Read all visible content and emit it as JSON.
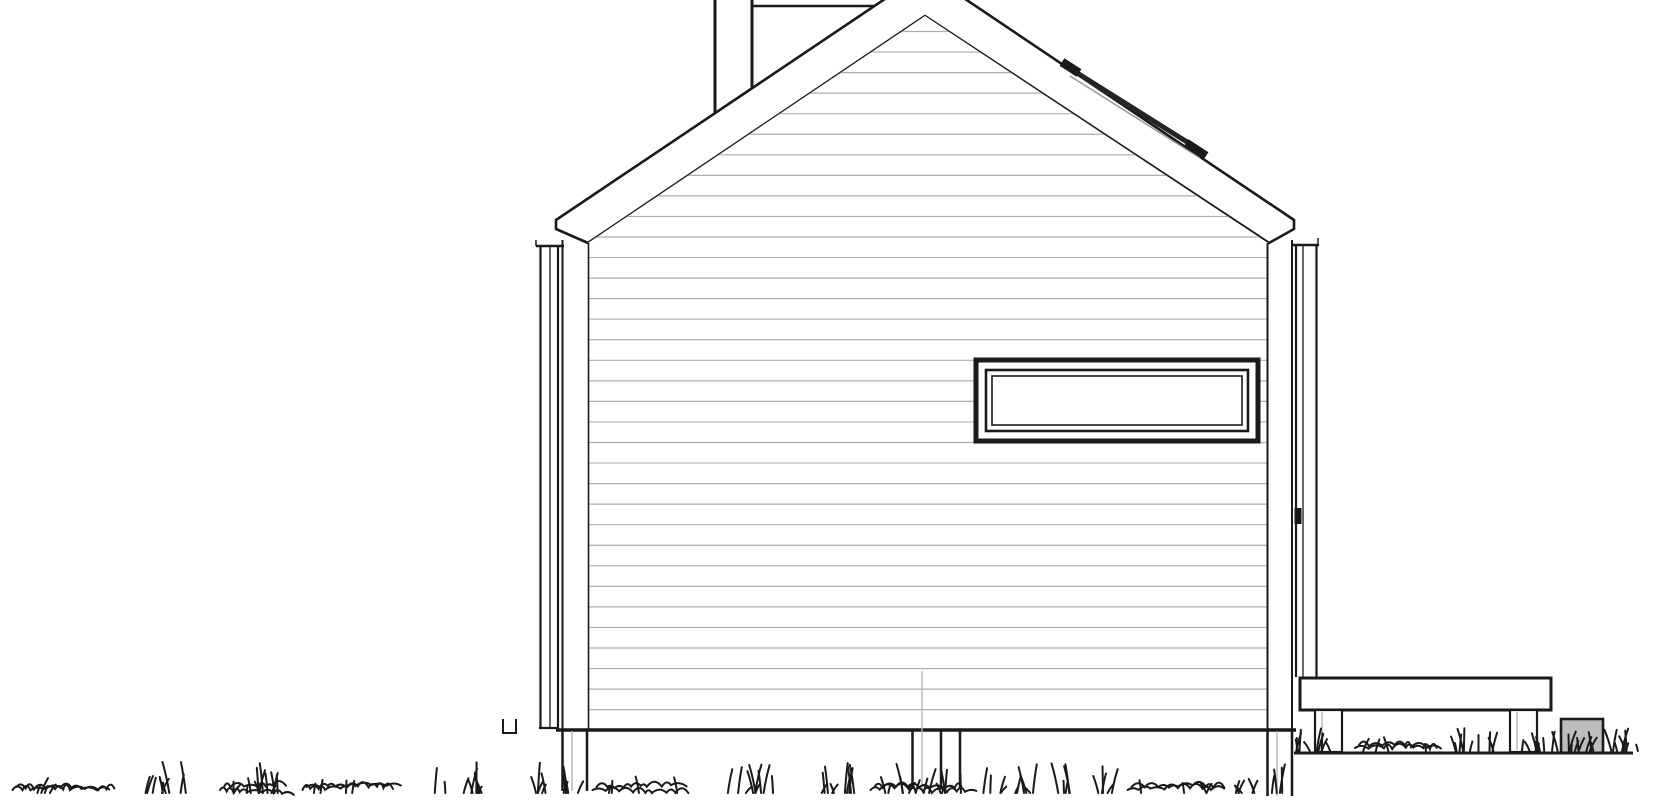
{
  "meta": {
    "description": "Architectural gable-end elevation drawing of a small house: gable roof with fascia band, chimney cut by image top, roof rail on right slope, horizontal lap siding, ribbon window, corner downspouts, pier foundation in grass, right-side deck on posts with stone block"
  },
  "canvas": {
    "w": 1670,
    "h": 800
  },
  "colors": {
    "background": "#ffffff",
    "line": "#1a1a1a",
    "siding_line": "#aeaeae",
    "soft_gray": "#b6b6b6",
    "stone_fill": "#bdbdbd",
    "rail_gray": "#9a9a9a"
  },
  "wall_clip": [
    [
      588,
      243
    ],
    [
      925,
      16
    ],
    [
      1268,
      243
    ],
    [
      1268,
      729
    ],
    [
      588,
      729
    ]
  ],
  "background_shapes": [
    {
      "n": "chimney-left-edge",
      "k": "line",
      "x1": 715,
      "y1": 0,
      "x2": 715,
      "y2": 118,
      "w": 3
    },
    {
      "n": "chimney-right-edge",
      "k": "line",
      "x1": 752,
      "y1": 0,
      "x2": 752,
      "y2": 92,
      "w": 3
    },
    {
      "n": "chimney-ledge",
      "k": "line",
      "x1": 752,
      "y1": 6,
      "x2": 876,
      "y2": 6,
      "w": 2.5
    },
    {
      "n": "roof-fascia-band",
      "k": "polygon",
      "pts": [
        [
          556,
          220
        ],
        [
          925,
          -28
        ],
        [
          1294,
          220
        ],
        [
          1294,
          229
        ],
        [
          1269,
          243
        ],
        [
          925,
          16
        ],
        [
          588,
          243
        ],
        [
          556,
          229
        ]
      ],
      "fill": "#ffffff",
      "w": 2.6
    },
    {
      "n": "gable-wall",
      "k": "polygon",
      "pts": [
        [
          588,
          243
        ],
        [
          925,
          16
        ],
        [
          1268,
          243
        ],
        [
          1268,
          729
        ],
        [
          588,
          729
        ]
      ],
      "fill": "#ffffff",
      "w": 0
    }
  ],
  "siding": {
    "x1": 588,
    "x2": 1268,
    "y_start": 31.5,
    "y_step": 20.55,
    "count": 34,
    "w": 1.2
  },
  "foreground_shapes": [
    {
      "n": "wall-left-edge",
      "k": "line",
      "x1": 588.5,
      "y1": 243,
      "x2": 588.5,
      "y2": 729,
      "w": 1.6
    },
    {
      "n": "wall-right-edge",
      "k": "line",
      "x1": 1267.5,
      "y1": 243,
      "x2": 1267.5,
      "y2": 729,
      "w": 2
    },
    {
      "n": "window-outer-frame",
      "k": "rect",
      "x": 976,
      "y": 360,
      "wd": 282,
      "h": 81,
      "fill": "#ffffff",
      "sw": 5
    },
    {
      "n": "window-mid-frame",
      "k": "rect",
      "x": 986,
      "y": 370,
      "wd": 262,
      "h": 61,
      "fill": "#ffffff",
      "sw": 2.6
    },
    {
      "n": "window-glass",
      "k": "rect",
      "x": 992,
      "y": 376,
      "wd": 250,
      "h": 49,
      "fill": "#ffffff",
      "sw": 1.6
    },
    {
      "n": "roof-rail-underline",
      "k": "line",
      "x1": 1070,
      "y1": 76,
      "x2": 1200,
      "y2": 158,
      "w": 1.5,
      "c": "#9a9a9a"
    },
    {
      "n": "roof-rail-bar",
      "k": "line",
      "x1": 1066,
      "y1": 66,
      "x2": 1203,
      "y2": 152,
      "w": 5,
      "c": "#242424"
    },
    {
      "n": "roof-rail-left-cap",
      "k": "line",
      "x1": 1062,
      "y1": 62,
      "x2": 1079,
      "y2": 73,
      "w": 9
    },
    {
      "n": "roof-rail-right-cap",
      "k": "line",
      "x1": 1186,
      "y1": 143,
      "x2": 1206,
      "y2": 156,
      "w": 9
    },
    {
      "n": "left-downspout-cap",
      "k": "line",
      "x1": 536,
      "y1": 246,
      "x2": 564,
      "y2": 246,
      "w": 2.5
    },
    {
      "n": "left-downspout-hook",
      "k": "line",
      "x1": 536,
      "y1": 240,
      "x2": 536,
      "y2": 246,
      "w": 1.5
    },
    {
      "n": "left-downspout-outer",
      "k": "line",
      "x1": 540.5,
      "y1": 247,
      "x2": 540.5,
      "y2": 728,
      "w": 2.2
    },
    {
      "n": "left-downspout-inner",
      "k": "line",
      "x1": 550,
      "y1": 247,
      "x2": 550,
      "y2": 728,
      "w": 1.3
    },
    {
      "n": "left-downspout-edge",
      "k": "line",
      "x1": 558,
      "y1": 247,
      "x2": 558,
      "y2": 728,
      "w": 2.2
    },
    {
      "n": "left-downspout-foot",
      "k": "line",
      "x1": 539,
      "y1": 728,
      "x2": 559,
      "y2": 728,
      "w": 2.2
    },
    {
      "n": "left-corner-trim",
      "k": "line",
      "x1": 562.5,
      "y1": 240,
      "x2": 562.5,
      "y2": 730,
      "w": 2
    },
    {
      "n": "right-corner-trim",
      "k": "line",
      "x1": 1292,
      "y1": 240,
      "x2": 1292,
      "y2": 730,
      "w": 2
    },
    {
      "n": "right-downspout-cap",
      "k": "line",
      "x1": 1293,
      "y1": 245,
      "x2": 1319,
      "y2": 245,
      "w": 2.5
    },
    {
      "n": "right-downspout-hook",
      "k": "line",
      "x1": 1318,
      "y1": 238,
      "x2": 1318,
      "y2": 245,
      "w": 1.5
    },
    {
      "n": "right-downspout-outer",
      "k": "line",
      "x1": 1296,
      "y1": 246,
      "x2": 1296,
      "y2": 677,
      "w": 2.2
    },
    {
      "n": "right-downspout-inner",
      "k": "line",
      "x1": 1303,
      "y1": 246,
      "x2": 1303,
      "y2": 677,
      "w": 1.3
    },
    {
      "n": "right-downspout-edge",
      "k": "line",
      "x1": 1316.5,
      "y1": 246,
      "x2": 1316.5,
      "y2": 677,
      "w": 2.2
    },
    {
      "n": "right-downspout-bracket",
      "k": "rect",
      "x": 1294.5,
      "y": 508,
      "wd": 7,
      "h": 16,
      "fill": "#1a1a1a",
      "sw": 0
    },
    {
      "n": "sill-base-line",
      "k": "line",
      "x1": 556,
      "y1": 730,
      "x2": 1296,
      "y2": 730,
      "w": 3.5
    },
    {
      "n": "left-pier-left-edge",
      "k": "line",
      "x1": 562.5,
      "y1": 731,
      "x2": 562.5,
      "y2": 791,
      "w": 2.5
    },
    {
      "n": "left-pier-center",
      "k": "line",
      "x1": 572,
      "y1": 731,
      "x2": 572,
      "y2": 791,
      "w": 1.4,
      "c": "#b6b6b6"
    },
    {
      "n": "left-pier-right-edge",
      "k": "line",
      "x1": 587,
      "y1": 731,
      "x2": 587,
      "y2": 791,
      "w": 2.5
    },
    {
      "n": "utility-drop-line",
      "k": "line",
      "x1": 922,
      "y1": 671,
      "x2": 922,
      "y2": 789,
      "w": 1.4,
      "c": "#b6b6b6"
    },
    {
      "n": "mid-pier-left-edge",
      "k": "line",
      "x1": 912.5,
      "y1": 731,
      "x2": 912.5,
      "y2": 789,
      "w": 2.5
    },
    {
      "n": "mid-pier-mid-edge",
      "k": "line",
      "x1": 941,
      "y1": 731,
      "x2": 941,
      "y2": 789,
      "w": 2.5
    },
    {
      "n": "mid-pier-right-edge",
      "k": "line",
      "x1": 960,
      "y1": 731,
      "x2": 960,
      "y2": 789,
      "w": 2.5
    },
    {
      "n": "right-pier-left-edge",
      "k": "line",
      "x1": 1267.5,
      "y1": 731,
      "x2": 1267.5,
      "y2": 796,
      "w": 2.5
    },
    {
      "n": "right-pier-center",
      "k": "line",
      "x1": 1277,
      "y1": 731,
      "x2": 1277,
      "y2": 796,
      "w": 1.4,
      "c": "#b6b6b6"
    },
    {
      "n": "right-pier-right-edge",
      "k": "line",
      "x1": 1292,
      "y1": 731,
      "x2": 1292,
      "y2": 796,
      "w": 2.5
    },
    {
      "n": "deck-slab",
      "k": "rect",
      "x": 1300,
      "y": 678,
      "wd": 251,
      "h": 32,
      "fill": "#ffffff",
      "sw": 3
    },
    {
      "n": "deck-post-left",
      "k": "rect",
      "x": 1315,
      "y": 710,
      "wd": 27,
      "h": 42,
      "fill": "#ffffff",
      "sw": 2.2
    },
    {
      "n": "deck-post-left-center",
      "k": "line",
      "x1": 1322,
      "y1": 712,
      "x2": 1322,
      "y2": 750,
      "w": 1.4,
      "c": "#b6b6b6"
    },
    {
      "n": "deck-post-right",
      "k": "rect",
      "x": 1510,
      "y": 710,
      "wd": 27,
      "h": 42,
      "fill": "#ffffff",
      "sw": 2.2
    },
    {
      "n": "deck-post-right-center",
      "k": "line",
      "x1": 1517,
      "y1": 712,
      "x2": 1517,
      "y2": 750,
      "w": 1.4,
      "c": "#b6b6b6"
    },
    {
      "n": "stone-block",
      "k": "rect",
      "x": 1561,
      "y": 719,
      "wd": 42,
      "h": 34,
      "fill": "#bdbdbd",
      "sw": 2.6
    },
    {
      "n": "right-ground-line",
      "k": "line",
      "x1": 1294,
      "y1": 753,
      "x2": 1633,
      "y2": 753,
      "w": 3
    },
    {
      "n": "small-ground-bracket",
      "k": "path",
      "d": "M 503 719 L 503 733 L 516 733 L 516 719",
      "w": 2
    }
  ],
  "grass": {
    "stroke_w": 2,
    "main_band": {
      "base_y": 793,
      "clusters": [
        {
          "x": 60,
          "w": 95,
          "t": "scribble"
        },
        {
          "x": 160,
          "w": 55,
          "t": "tuft"
        },
        {
          "x": 255,
          "w": 70,
          "t": "mixed"
        },
        {
          "x": 350,
          "w": 95,
          "t": "scribble"
        },
        {
          "x": 462,
          "w": 55,
          "t": "tuft"
        },
        {
          "x": 548,
          "w": 60,
          "t": "tuft"
        },
        {
          "x": 640,
          "w": 95,
          "t": "scribble"
        },
        {
          "x": 748,
          "w": 55,
          "t": "tuft"
        },
        {
          "x": 828,
          "w": 60,
          "t": "tuft"
        },
        {
          "x": 918,
          "w": 95,
          "t": "mixed"
        },
        {
          "x": 1008,
          "w": 55,
          "t": "tuft"
        },
        {
          "x": 1085,
          "w": 60,
          "t": "tuft"
        },
        {
          "x": 1175,
          "w": 95,
          "t": "scribble"
        },
        {
          "x": 1258,
          "w": 50,
          "t": "tuft"
        }
      ]
    },
    "right_band": {
      "base_y": 751,
      "clusters": [
        {
          "x": 1315,
          "w": 45,
          "t": "tuft"
        },
        {
          "x": 1395,
          "w": 80,
          "t": "scribble"
        },
        {
          "x": 1475,
          "w": 50,
          "t": "tuft"
        },
        {
          "x": 1540,
          "w": 40,
          "t": "tuft"
        },
        {
          "x": 1582,
          "w": 40,
          "t": "tuft"
        },
        {
          "x": 1625,
          "w": 28,
          "t": "tuft"
        }
      ]
    }
  }
}
